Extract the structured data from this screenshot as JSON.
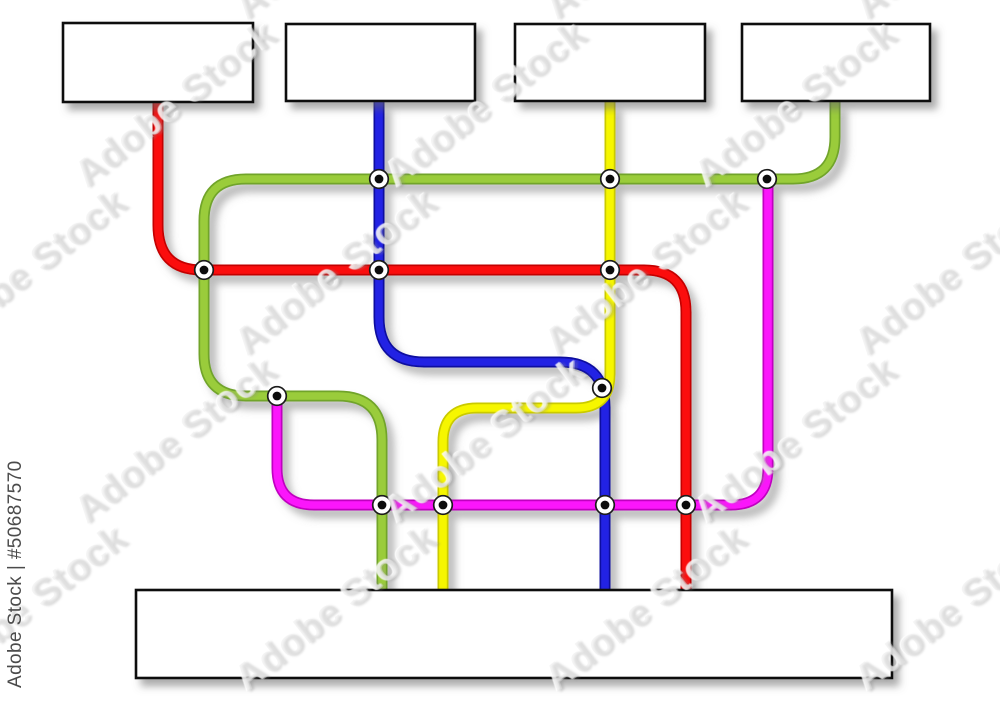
{
  "artboard": {
    "width": 1000,
    "height": 707,
    "background": "#ffffff"
  },
  "watermark": {
    "tile_text": "Adobe Stock",
    "attribution": "Adobe Stock | #50687570"
  },
  "diagram": {
    "line_width": 11,
    "boxes": [
      {
        "id": "top-box-1",
        "label": "",
        "x": 63,
        "y": 23,
        "w": 190,
        "h": 79
      },
      {
        "id": "top-box-2",
        "label": "",
        "x": 286,
        "y": 24,
        "w": 189,
        "h": 77
      },
      {
        "id": "top-box-3",
        "label": "",
        "x": 515,
        "y": 24,
        "w": 190,
        "h": 77
      },
      {
        "id": "top-box-4",
        "label": "",
        "x": 742,
        "y": 24,
        "w": 188,
        "h": 77
      },
      {
        "id": "bottom-box",
        "label": "",
        "x": 136,
        "y": 590,
        "w": 756,
        "h": 88
      }
    ],
    "lines": [
      {
        "id": "green-line",
        "core": "#9ACC3A",
        "edge": "#71A42C",
        "path": "M835 102 V137 Q835 179 793 179 H246 Q204 179 204 221 V354 Q204 396 246 396 H338 Q382 396 382 440 V590"
      },
      {
        "id": "red-line",
        "core": "#FB0F0F",
        "edge": "#C40404",
        "path": "M158 102 V225 Q158 270 202 270 H644 Q686 270 686 312 V590"
      },
      {
        "id": "blue-line",
        "core": "#2424E4",
        "edge": "#1111A0",
        "path": "M379 102 V317 Q379 362 424 362 H560 Q605 362 605 407 V590"
      },
      {
        "id": "yellow-line",
        "core": "#F6F600",
        "edge": "#CACA00",
        "path": "M610 102 V374 Q610 408 576 408 H477 Q443 408 443 442 V590"
      },
      {
        "id": "magenta-line",
        "core": "#FB16FB",
        "edge": "#C003C0",
        "path": "M277 396 V468 Q277 505 314 505 H731 Q768 505 768 468 V179"
      }
    ],
    "station_style": {
      "outer_r": 9.3,
      "ring": "#1b1b1b",
      "ring_w": 1.7,
      "fill": "#ffffff",
      "inner_r": 4.4,
      "inner": "#0c0c0c"
    },
    "stations": [
      {
        "x": 379,
        "y": 179
      },
      {
        "x": 610,
        "y": 179
      },
      {
        "x": 767,
        "y": 179
      },
      {
        "x": 204,
        "y": 270
      },
      {
        "x": 379,
        "y": 270
      },
      {
        "x": 610,
        "y": 270
      },
      {
        "x": 277,
        "y": 396
      },
      {
        "x": 602,
        "y": 388
      },
      {
        "x": 382,
        "y": 505
      },
      {
        "x": 443,
        "y": 505
      },
      {
        "x": 605,
        "y": 505
      },
      {
        "x": 686,
        "y": 505
      }
    ]
  }
}
